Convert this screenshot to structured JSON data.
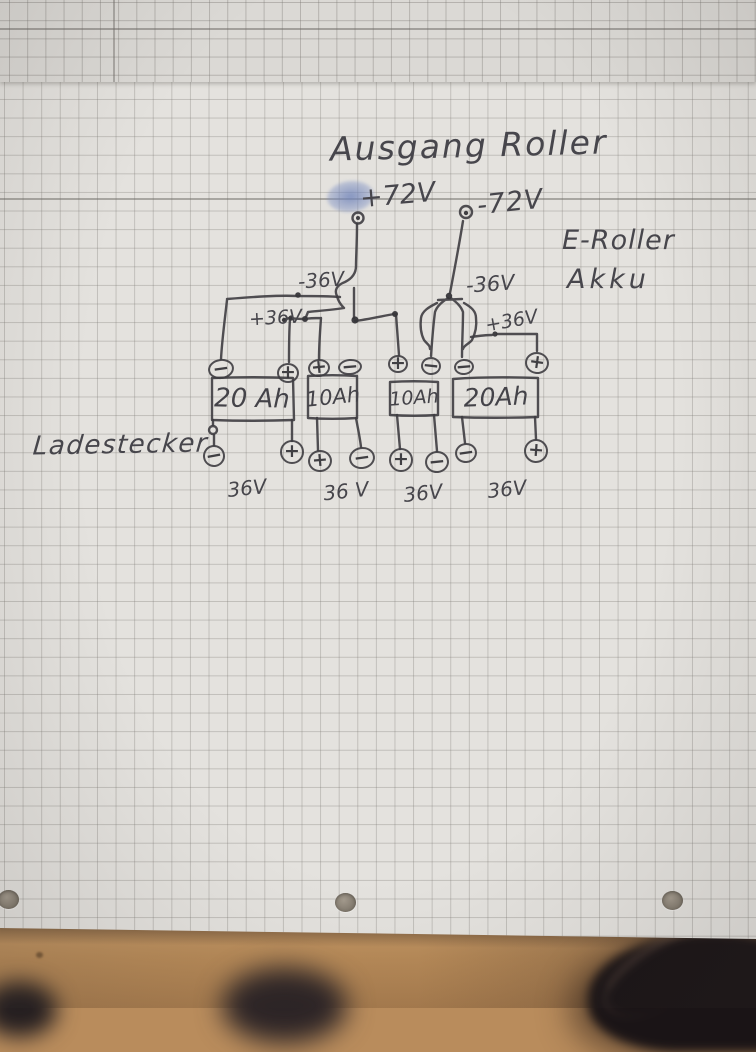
{
  "labels": {
    "title": "Ausgang Roller",
    "output_plus": "+72V",
    "output_minus": "-72V",
    "side_line1": "E-Roller",
    "side_line2": "Akku",
    "rail_minus36_left": "-36V",
    "rail_plus36_left": "+36V",
    "rail_minus36_right": "-36V",
    "rail_plus36_right": "+36V",
    "charger": "Ladestecker"
  },
  "batteries": [
    {
      "capacity": "20 Ah",
      "voltage": "36V",
      "cx": 252,
      "cy": 399,
      "fs": 26,
      "rot": 1,
      "vx": 247,
      "vy": 488
    },
    {
      "capacity": "10Ah",
      "voltage": "36 V",
      "cx": 333,
      "cy": 397,
      "fs": 21,
      "rot": -6,
      "vx": 346,
      "vy": 491
    },
    {
      "capacity": "10Ah",
      "voltage": "36V",
      "cx": 414,
      "cy": 398,
      "fs": 19,
      "rot": -4,
      "vx": 423,
      "vy": 493
    },
    {
      "capacity": "20Ah",
      "voltage": "36V",
      "cx": 496,
      "cy": 397,
      "fs": 25,
      "rot": -2,
      "vx": 507,
      "vy": 489
    }
  ],
  "terminals": [
    {
      "name": "b1-top-minus",
      "sign": "−",
      "x": 221,
      "y": 369,
      "rx": 13,
      "ry": 10,
      "rot": -8
    },
    {
      "name": "b1-top-plus",
      "sign": "+",
      "x": 288,
      "y": 373,
      "rx": 11,
      "ry": 10,
      "rot": 0
    },
    {
      "name": "b2-top-plus",
      "sign": "+",
      "x": 319,
      "y": 368,
      "rx": 11,
      "ry": 9,
      "rot": -6
    },
    {
      "name": "b2-top-minus",
      "sign": "−",
      "x": 350,
      "y": 367,
      "rx": 12,
      "ry": 8,
      "rot": -5
    },
    {
      "name": "b3-top-plus",
      "sign": "+",
      "x": 398,
      "y": 364,
      "rx": 10,
      "ry": 9,
      "rot": 0
    },
    {
      "name": "b3-top-minus",
      "sign": "−",
      "x": 431,
      "y": 366,
      "rx": 10,
      "ry": 9,
      "rot": 6
    },
    {
      "name": "b4-top-minus",
      "sign": "−",
      "x": 464,
      "y": 367,
      "rx": 10,
      "ry": 8,
      "rot": -5
    },
    {
      "name": "b4-top-plus",
      "sign": "+",
      "x": 537,
      "y": 363,
      "rx": 12,
      "ry": 11,
      "rot": 8
    },
    {
      "name": "charger-minus",
      "sign": "−",
      "x": 214,
      "y": 456,
      "rx": 11,
      "ry": 11,
      "rot": -10
    },
    {
      "name": "b1-bottom-plus",
      "sign": "+",
      "x": 292,
      "y": 452,
      "rx": 12,
      "ry": 12,
      "rot": 0
    },
    {
      "name": "b2-bottom-plus",
      "sign": "+",
      "x": 320,
      "y": 461,
      "rx": 12,
      "ry": 11,
      "rot": -5
    },
    {
      "name": "b2-bottom-minus",
      "sign": "−",
      "x": 362,
      "y": 458,
      "rx": 13,
      "ry": 11,
      "rot": -8
    },
    {
      "name": "b3-bottom-plus",
      "sign": "+",
      "x": 401,
      "y": 460,
      "rx": 12,
      "ry": 12,
      "rot": 0
    },
    {
      "name": "b3-bottom-minus",
      "sign": "−",
      "x": 437,
      "y": 462,
      "rx": 12,
      "ry": 11,
      "rot": -6
    },
    {
      "name": "b4-bottom-minus",
      "sign": "−",
      "x": 466,
      "y": 453,
      "rx": 11,
      "ry": 10,
      "rot": -8
    },
    {
      "name": "b4-bottom-plus",
      "sign": "+",
      "x": 536,
      "y": 451,
      "rx": 12,
      "ry": 12,
      "rot": 4
    }
  ],
  "colors": {
    "ink": "#3e3d41",
    "paper": "#e4e2de",
    "wood": "#bb9164",
    "smudge": "#8ea0cc"
  }
}
